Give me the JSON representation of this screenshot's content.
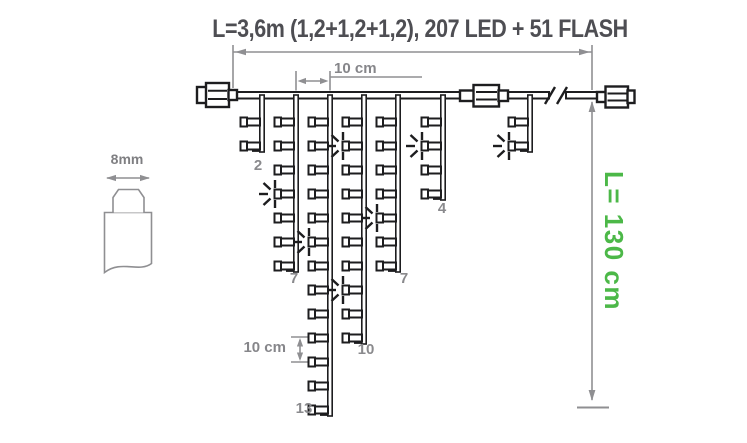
{
  "title": "L=3,6m (1,2+1,2+1,2), 207 LED + 51 FLASH",
  "colors": {
    "ink": "#1d1d1f",
    "dim_gray": "#8f8f92",
    "label_gray": "#8a8a8d",
    "title_gray": "#4e4e53",
    "accent_green": "#4cb848",
    "background": "#ffffff"
  },
  "cable_detail": {
    "width_label": "8mm"
  },
  "dimensions": {
    "drop_spacing_label": "10 cm",
    "led_spacing_label": "10 cm",
    "height_label": "L= 130 cm"
  },
  "garland": {
    "wire_y": 92,
    "led_start_y": 122,
    "led_step": 24,
    "drops": [
      {
        "x": 262,
        "leds": 2,
        "flash_rows": [],
        "count_label": "2",
        "label_pos": [
          258,
          171
        ]
      },
      {
        "x": 296,
        "leds": 7,
        "flash_rows": [
          4
        ],
        "count_label": "7",
        "label_pos": [
          294,
          284
        ]
      },
      {
        "x": 330,
        "leds": 13,
        "flash_rows": [
          6
        ],
        "count_label": "13",
        "label_pos": [
          304,
          414
        ]
      },
      {
        "x": 364,
        "leds": 10,
        "flash_rows": [
          2,
          8
        ],
        "count_label": "10",
        "label_pos": [
          366,
          355
        ]
      },
      {
        "x": 398,
        "leds": 7,
        "flash_rows": [
          5
        ],
        "count_label": "7",
        "label_pos": [
          404,
          284
        ]
      },
      {
        "x": 443,
        "leds": 4,
        "flash_rows": [
          2
        ],
        "count_label": "4",
        "label_pos": [
          442,
          214
        ]
      },
      {
        "x": 530,
        "leds": 2,
        "flash_rows": [
          2
        ],
        "count_label": "",
        "label_pos": [
          0,
          0
        ]
      }
    ]
  }
}
